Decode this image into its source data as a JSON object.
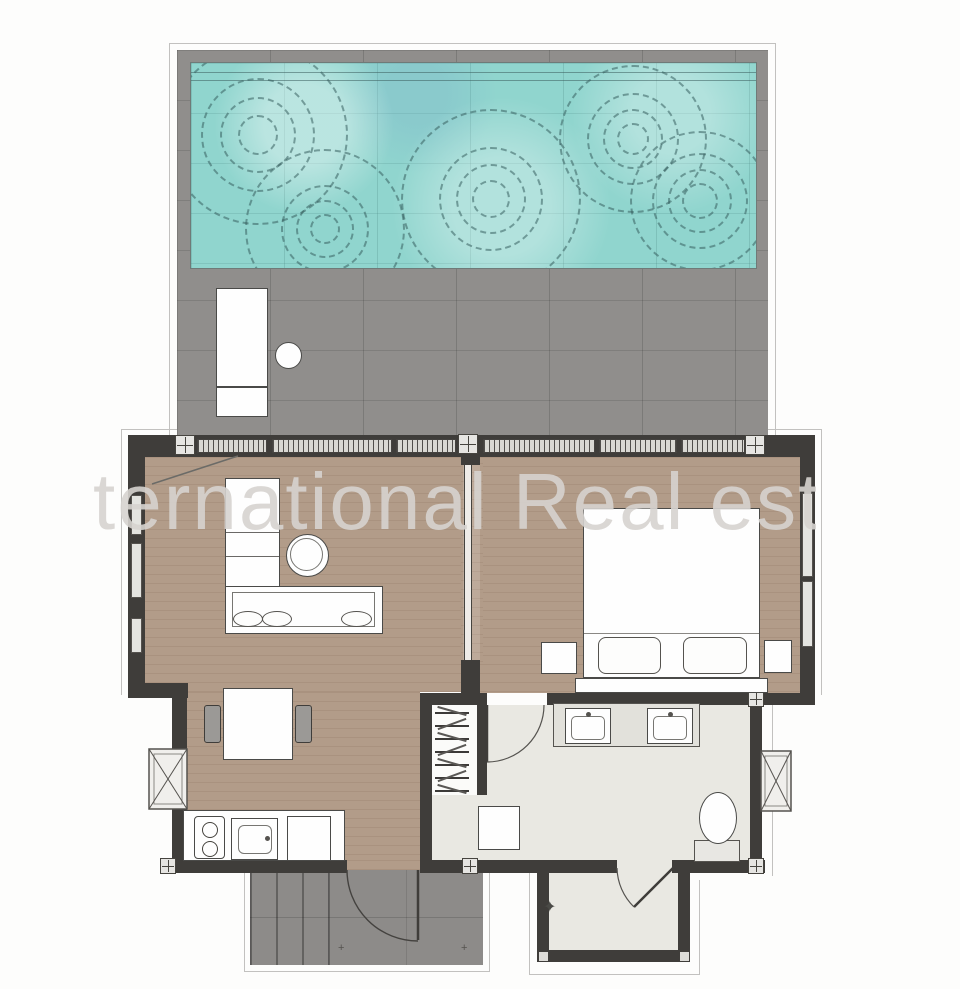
{
  "watermark": {
    "text": "ternational Real est"
  },
  "symbols": {
    "plant_marker": "✦",
    "terrace_mark_left": "+",
    "terrace_mark_right": "+"
  },
  "colors": {
    "pool_water": "#90d5ce",
    "ripple_line": "#375f5f",
    "deck_gray": "#908e8c",
    "terrace_gray": "#8d8b89",
    "wood_floor": "#b29c89",
    "bathroom_floor": "#e9e8e2",
    "wall_dark": "#3f3d3a",
    "furniture_white": "#fefefe",
    "watermark_gray": "#d6d3cf"
  }
}
